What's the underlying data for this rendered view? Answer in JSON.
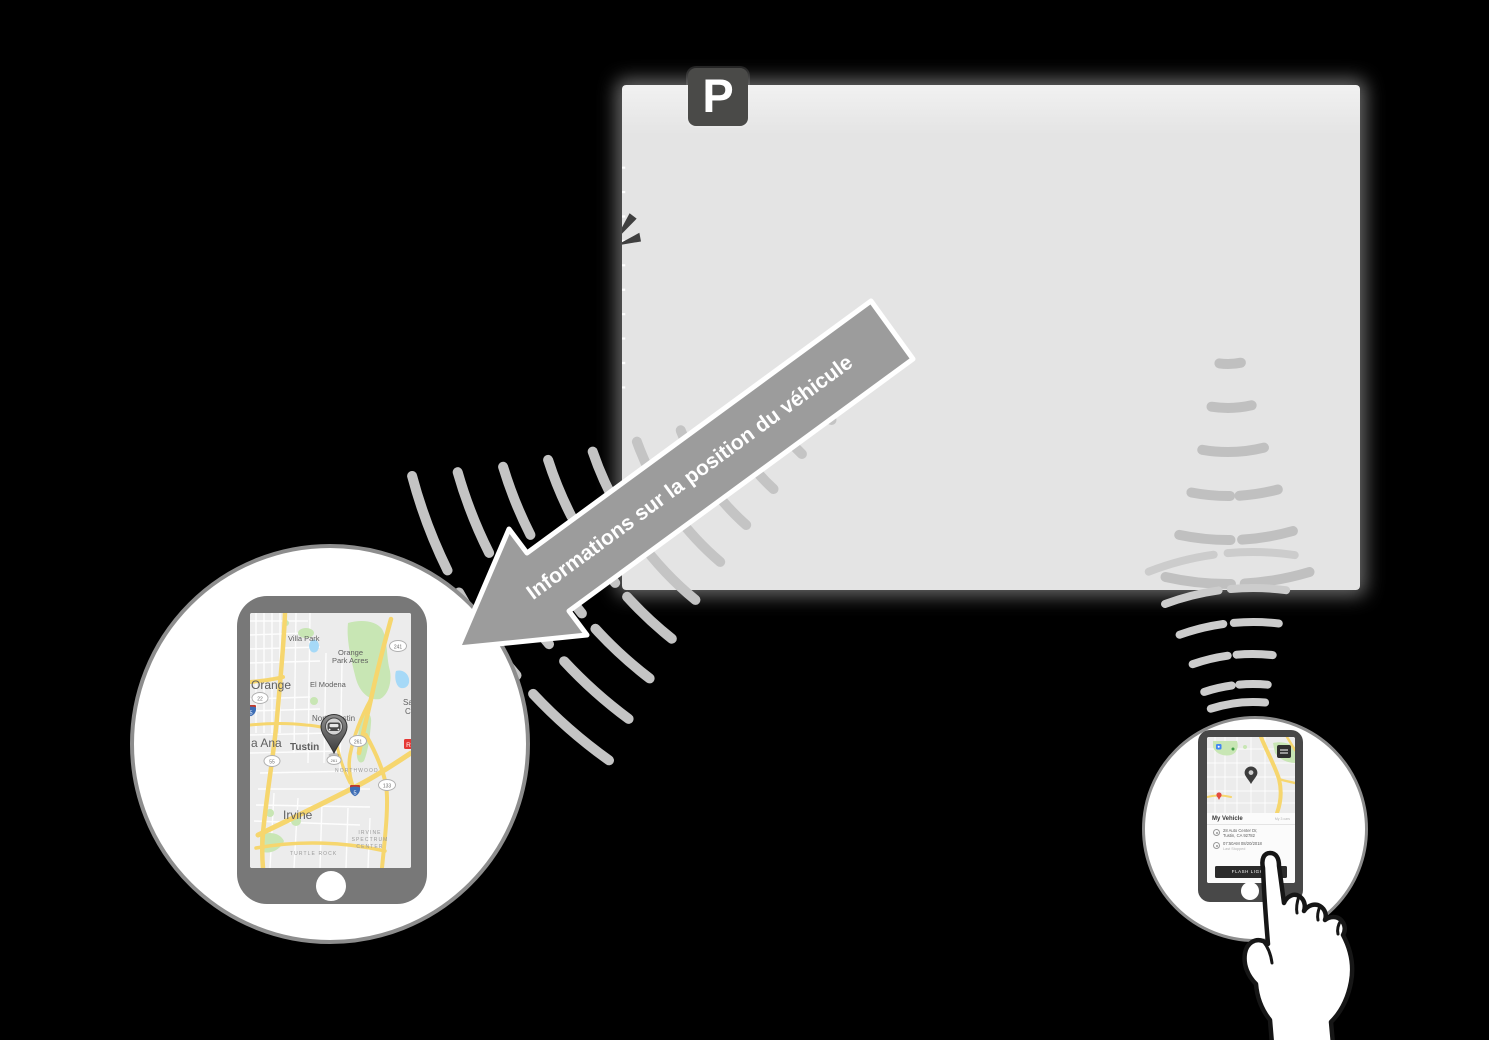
{
  "parking_lot": {
    "sign": "P"
  },
  "arrow": {
    "label": "Informations sur la position du véhicule"
  },
  "left_phone": {
    "map": {
      "towns": {
        "villa_park": "Villa Park",
        "orange_park_acres_line1": "Orange",
        "orange_park_acres_line2": "Park Acres",
        "orange": "Orange",
        "el_modena": "El Modena",
        "north_tustin": "North Tustin",
        "santa_ana": "a Ana",
        "tustin": "Tustin",
        "irvine": "Irvine"
      },
      "districts": {
        "northwood": "NORTHWOOD",
        "turtle_rock": "TURTLE ROCK",
        "spectrum_line1": "IRVINE",
        "spectrum_line2": "SPECTRUM",
        "spectrum_line3": "CENTER"
      },
      "shields": {
        "sr22": "22",
        "sr241": "241",
        "sr261": "261",
        "sr261_small": "261",
        "sr55": "55",
        "sr133": "133",
        "i5": "5",
        "i5_left": "5"
      },
      "edge_labels": {
        "sa": "Sa",
        "c": "C",
        "red_poi": "R"
      }
    }
  },
  "right_phone": {
    "app": {
      "title": "My Vehicle",
      "meta": "My 3 cars",
      "address_line1": "28 Auto Center Dr,",
      "address_line2": "Tustin, CA 92782",
      "timestamp": "07:50AM 08/20/2018",
      "timestamp_caption": "Last Stopped",
      "cta": "FLASH LIGHTS"
    }
  },
  "colors": {
    "background": "#000000",
    "lot": "#e4e4e4",
    "arrow": "#9c9c9c",
    "signal": "#c4c4c4",
    "highlight_car_fill": "#d8d8d8",
    "road_yellow": "#f6d66e",
    "map_green": "#c8e6b4",
    "map_water": "#a6d9f7",
    "poi_red": "#e53935",
    "phone_left_body": "#787878",
    "phone_right_body": "#484848",
    "circle_border": "#8d8d8d"
  }
}
